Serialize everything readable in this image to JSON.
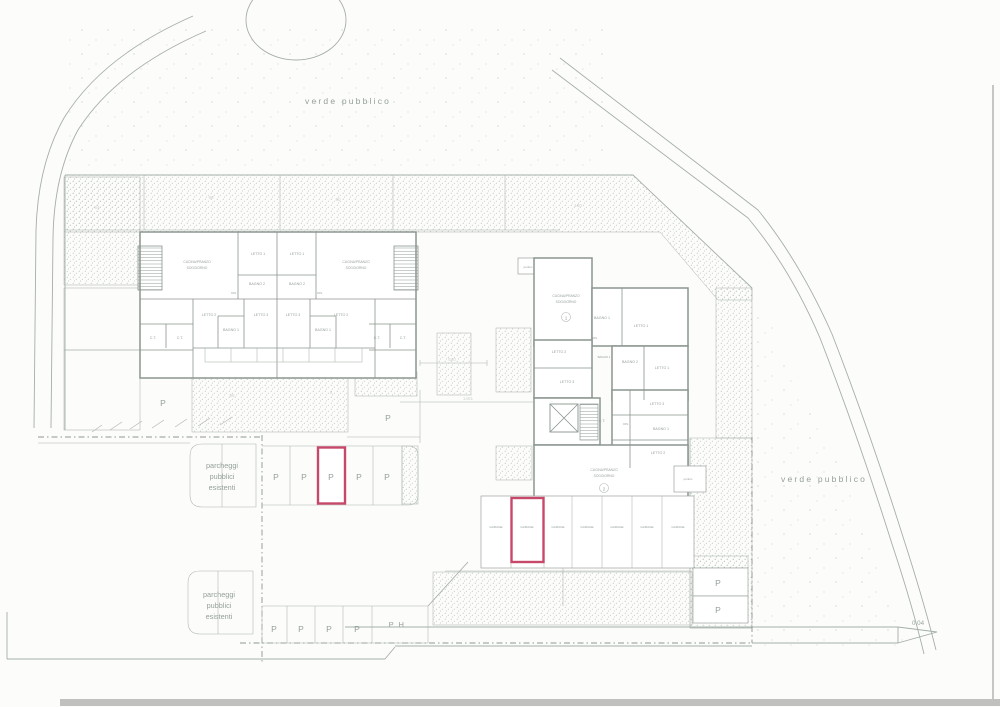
{
  "labels": {
    "verde": "verde pubblico",
    "parcheggi": {
      "l1": "parcheggi",
      "l2": "pubblici",
      "l3": "esistenti"
    },
    "p": "P",
    "ph": "P H",
    "garage": "GARAGE",
    "rooms": {
      "cucina1": "CUCINA/PRANZO",
      "cucina2": "SOGGIORNO",
      "letto1": "LETTO 1",
      "letto2": "LETTO 2",
      "letto3": "LETTO 3",
      "bagno1": "BAGNO 1",
      "bagno2": "BAGNO 2",
      "dis": "DIS.",
      "ct": "C.T.",
      "portico": "portico"
    },
    "units": {
      "u1": "1",
      "u2": "2"
    },
    "elevation": "0.04",
    "faint": {
      "a": "64",
      "b": "90",
      "c": "50",
      "d": "180",
      "e": "58",
      "f": "6",
      "g": "500",
      "h": "1481"
    }
  },
  "colors": {
    "highlight": "#c7496a",
    "line": "#9aa49f",
    "paper": "#fcfcfb"
  }
}
